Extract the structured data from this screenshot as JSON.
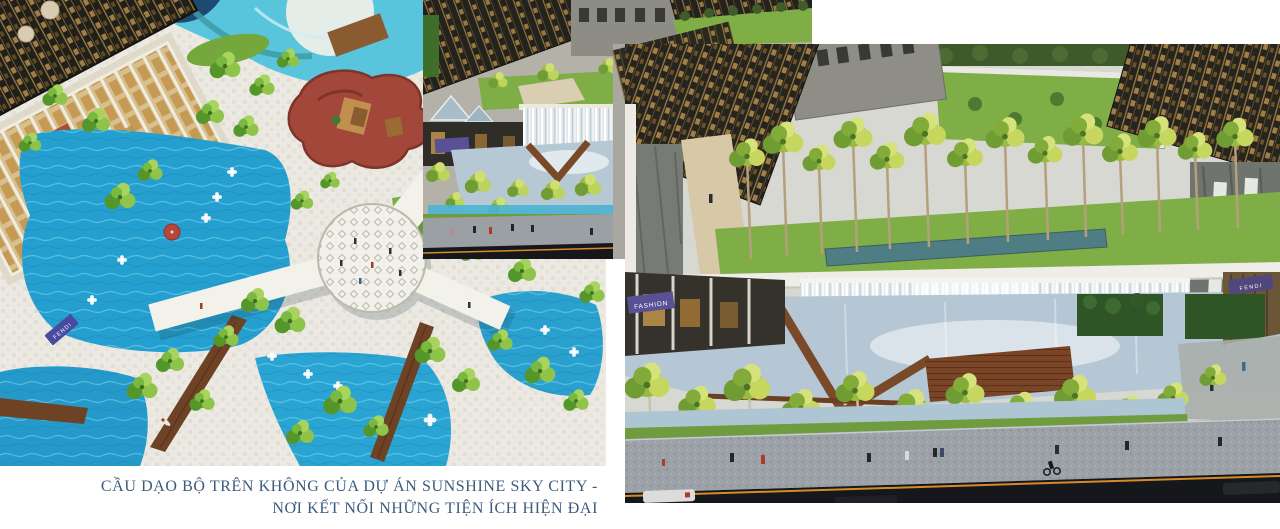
{
  "canvas": {
    "width": 1280,
    "height": 529,
    "background": "#ffffff"
  },
  "caption": {
    "line1": "CẦU DẠO BỘ TRÊN KHÔNG CỦA DỰ ÁN SUNSHINE SKY CITY -",
    "line2": "NƠI KẾT NỐI NHỮNG TIỆN ÍCH HIỆN ĐẠI",
    "color": "#3c5a7c"
  },
  "ribbon": {
    "color": "#1e3a5e"
  },
  "renders": {
    "left": {
      "description": "aerial view of pool deck with Y-shaped sky walkway",
      "signs": {
        "fendi": "FENDI"
      }
    },
    "middle": {
      "description": "overview of waterfall plaza and promenade"
    },
    "right": {
      "description": "waterfall promenade with palm rows, sidewalk and street",
      "signs": {
        "fashion": "FASHION",
        "fendi": "FENDI"
      }
    }
  },
  "palette": {
    "pool_blue": "#259fcf",
    "pale_pool": "#b5c7d4",
    "palm_green": "#8fc44a",
    "lawn_green": "#7fae46",
    "wood_brown": "#7a4a28",
    "playground_red": "#a2473a",
    "banner_purple": "#5a5096",
    "facade_dark": "#23211c",
    "facade_gold": "#8f7440",
    "road_dark": "#15171b",
    "road_line_orange": "#d78a28",
    "navy": "#1e3a5e"
  }
}
